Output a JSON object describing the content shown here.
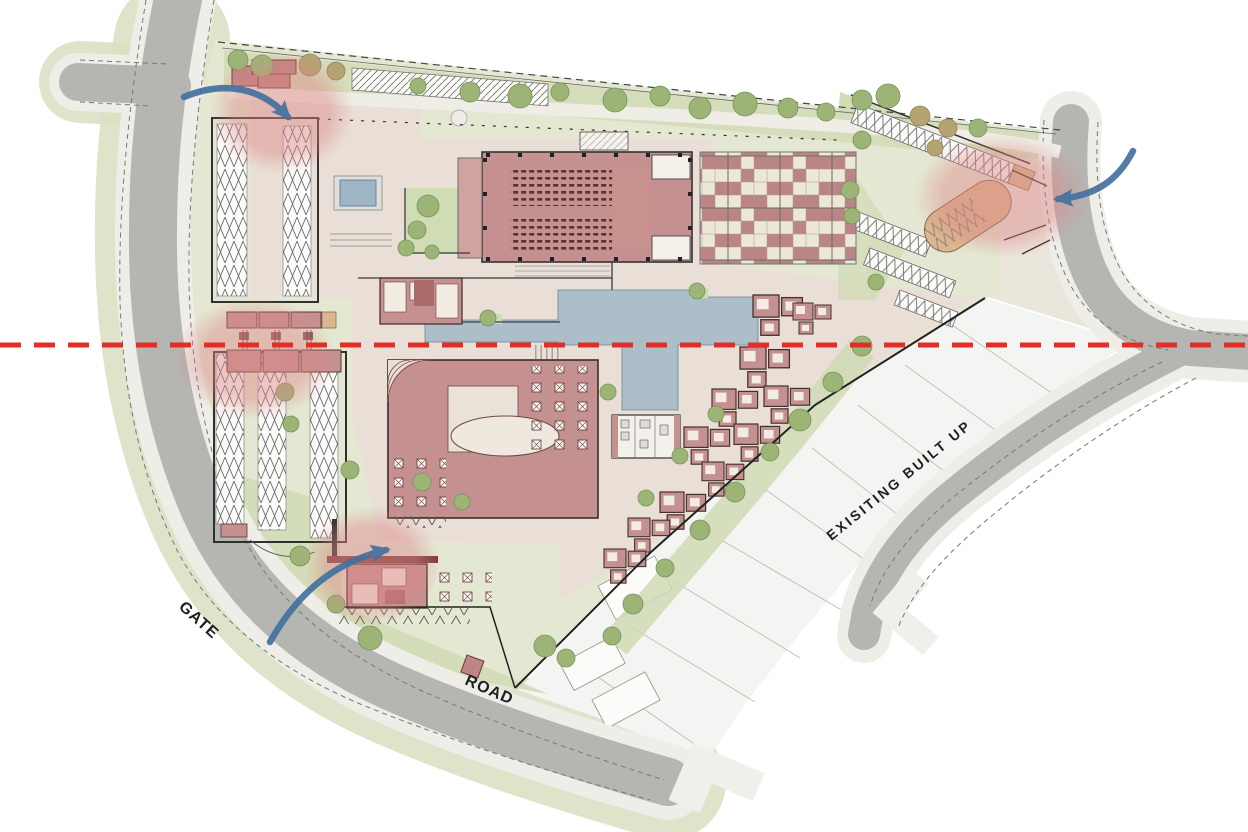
{
  "document": {
    "type": "architectural-site-plan",
    "description": "Watercolor-style campus master plan with perimeter roads, entry arrows, entry highlight circles and a red section cut line",
    "background": "#ffffff"
  },
  "labels": {
    "gate": "GATE",
    "road": "ROAD",
    "existing_built_up": "EXISITING BUILT UP"
  },
  "annotations": {
    "section_line": {
      "name": "section-cut-line",
      "style": "dashed",
      "orientation": "horizontal",
      "color": "#e12f28",
      "y_px": 345
    },
    "entry_arrows": {
      "color": "#44719f",
      "items": [
        "north-west-entry-arrow",
        "north-east-entry-arrow",
        "south-west-entry-arrow"
      ]
    },
    "entry_highlights": {
      "color": "#dd8585",
      "items": [
        "north-west-parking-entry",
        "west-gate-entry",
        "north-east-parking-entry",
        "south-service-entry"
      ]
    }
  },
  "palette": {
    "road": "#b5b5b2",
    "sidewalk": "#eeede7",
    "verge_green": "#dbe0c3",
    "lawn": "#d3dcb8",
    "site_ground": "#e4e8d3",
    "hardscape": "#e9dfd6",
    "building": "#c59190",
    "building_outline": "#3b2b29",
    "hall_seats": "#5d2f2f",
    "water": "#a9bec9",
    "checker_red": "#bb8486",
    "checker_cream": "#ece7d6",
    "existing_plots": "#f4f4f2",
    "tan_dropoff": "#d9b88f",
    "tree_green": "#9cb577",
    "tree_olive": "#b3a472",
    "section_red": "#e12f28",
    "arrow_blue": "#44719f",
    "highlight_pink": "#dd8585"
  },
  "features": [
    "perimeter-road-west",
    "access-road-south",
    "access-road-north-east",
    "multipurpose-hall-with-auditorium-seating",
    "checkerboard-plaza",
    "reflecting-pool",
    "central-water-court",
    "clubhouse-block",
    "dining-canteen-terrace",
    "cottage-clusters",
    "surface-parking-north-west",
    "surface-parking-west",
    "angled-parking-north-east",
    "drop-off-loop",
    "existing-built-up-plots",
    "gate-complex",
    "lawns-and-trees"
  ]
}
